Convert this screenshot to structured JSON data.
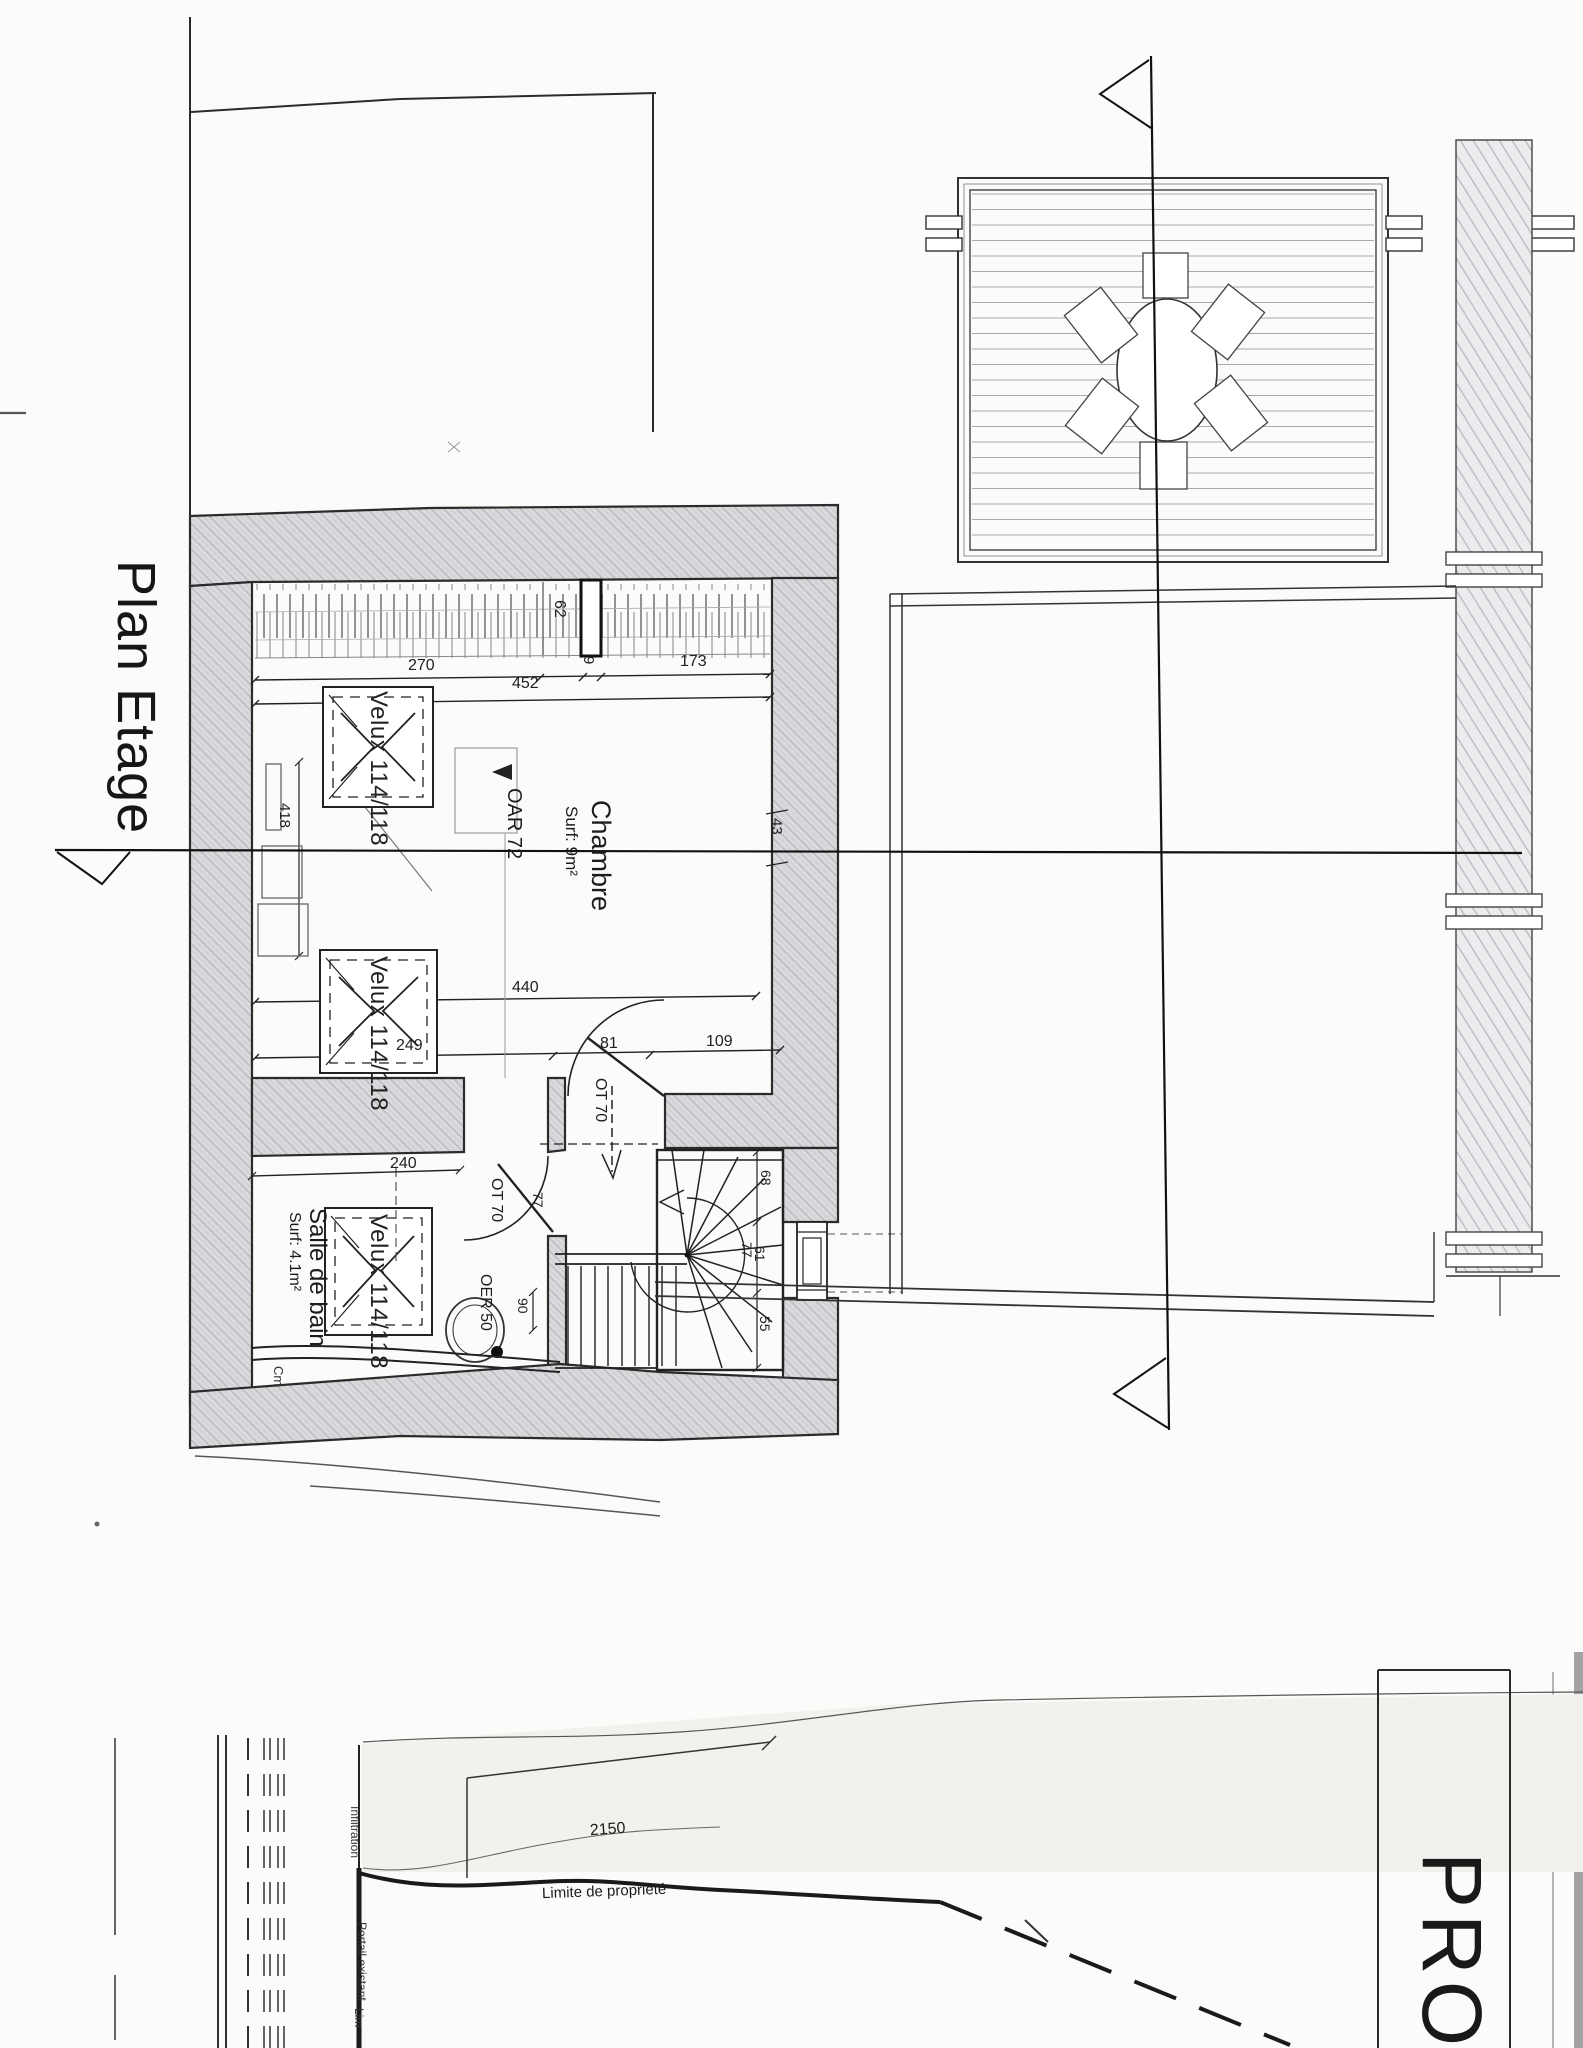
{
  "page": {
    "plan_title": "Plan Etage",
    "project_title": "PRO"
  },
  "rooms": {
    "chambre": {
      "name": "Chambre",
      "surface": "Surf: 9m²"
    },
    "salle_de_bain": {
      "name": "Salle de bain",
      "surface": "Surf: 4.1m²"
    }
  },
  "labels": {
    "velux1": "Velux 114/118",
    "velux2": "Velux 114/118",
    "velux3": "Velux 114/118",
    "oar": "OAR 72",
    "oer": "OER 50",
    "door_chambre": "OT 70",
    "door_bain": "OT 70",
    "cm": "Cm"
  },
  "dims": {
    "top_270": "270",
    "top_452": "452",
    "top_173": "173",
    "top_62": "62",
    "top_9": "9",
    "left_418": "418",
    "right_43": "43",
    "mid_440": "440",
    "row_249": "249",
    "row_81": "81",
    "row_109": "109",
    "bain_240": "240",
    "bain_77": "77",
    "bain_90": "90",
    "stair_68": "68",
    "stair_77": "77",
    "stair_61": "61",
    "stair_55": "55"
  },
  "site": {
    "dim_2150": "2150",
    "limite": "Limite de propriété",
    "infiltration": "Infiltration",
    "portail": "Portail existant",
    "lim_partial": "Lim"
  }
}
